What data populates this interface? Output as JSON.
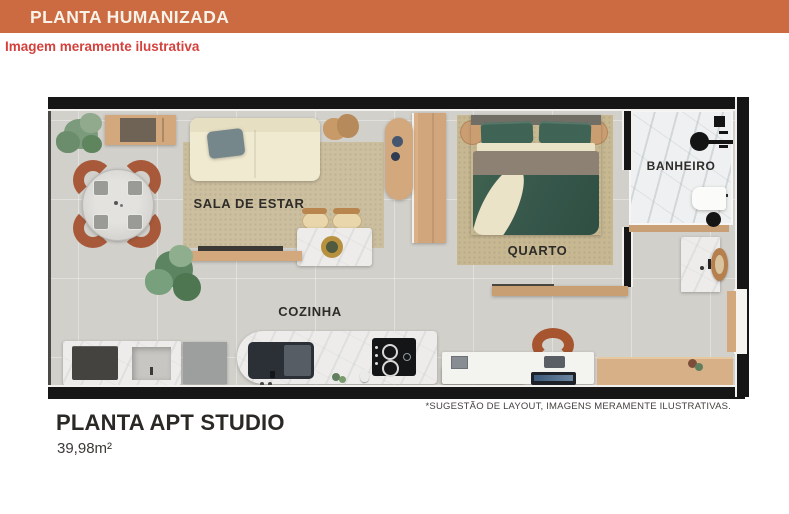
{
  "header": {
    "title": "PLANTA HUMANIZADA"
  },
  "notice": {
    "text": "Imagem meramente ilustrativa"
  },
  "floorplan": {
    "rooms": [
      {
        "id": "sala-de-estar",
        "label": "SALA DE ESTAR"
      },
      {
        "id": "quarto",
        "label": "QUARTO"
      },
      {
        "id": "banheiro",
        "label": "BANHEIRO"
      },
      {
        "id": "cozinha",
        "label": "COZINHA"
      }
    ]
  },
  "footer": {
    "disclaimer": "*SUGESTÃO DE LAYOUT, IMAGENS MERAMENTE ILUSTRATIVAS.",
    "plan_name": "PLANTA APT STUDIO",
    "area": "39,98m²"
  },
  "colors": {
    "header_bg": "#cc6a42",
    "header_text": "#f8f3e8",
    "notice_text": "#d4413c",
    "wall": "#161616",
    "floor": "#d2d0cb",
    "wood": "#d3a87d",
    "bed_green": "#3a5c4d",
    "terracotta": "#a8593a"
  }
}
